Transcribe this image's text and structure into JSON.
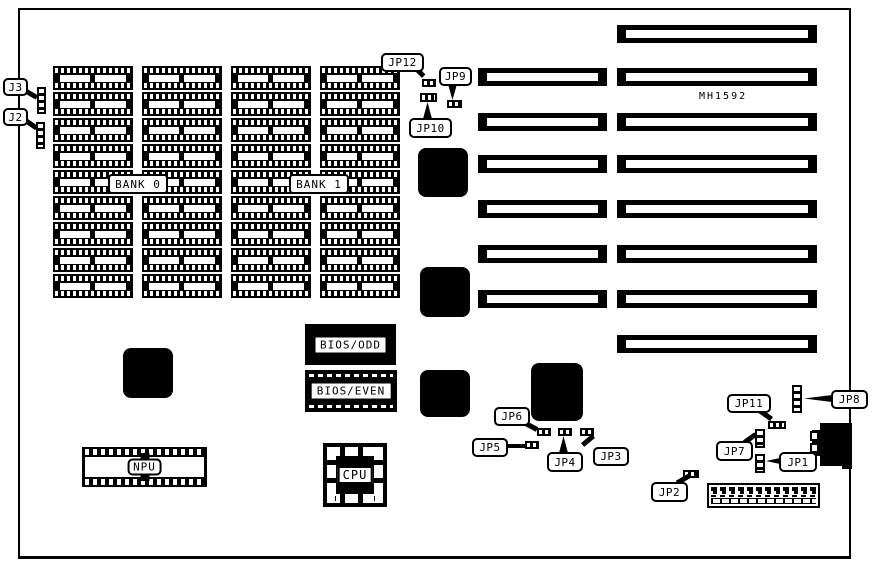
{
  "colors": {
    "ink": "#000000",
    "paper": "#ffffff"
  },
  "board": {
    "model": "MH1592"
  },
  "memory": {
    "rows": 9,
    "cols": 4,
    "banks": [
      {
        "label": "BANK 0"
      },
      {
        "label": "BANK 1"
      }
    ]
  },
  "slots": {
    "left_count": 6,
    "right_count": 8
  },
  "components": {
    "bios_odd": "BIOS/ODD",
    "bios_even": "BIOS/EVEN",
    "npu": "NPU",
    "cpu": "CPU"
  },
  "jumper_labels": {
    "j3": "J3",
    "j2": "J2",
    "jp1": "JP1",
    "jp2": "JP2",
    "jp3": "JP3",
    "jp4": "JP4",
    "jp5": "JP5",
    "jp6": "JP6",
    "jp7": "JP7",
    "jp8": "JP8",
    "jp9": "JP9",
    "jp10": "JP10",
    "jp11": "JP11",
    "jp12": "JP12"
  }
}
